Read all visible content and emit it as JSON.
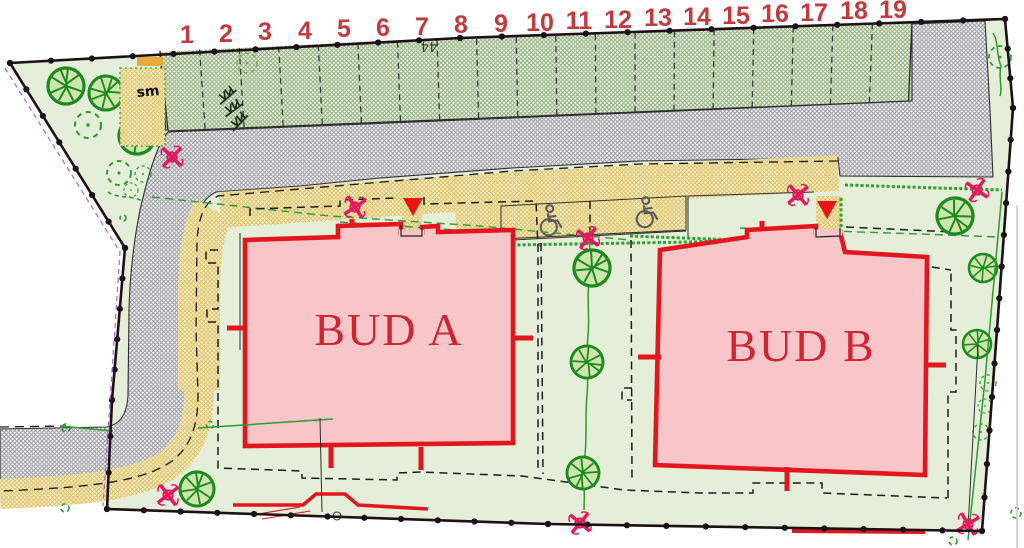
{
  "plan": {
    "title": "Site development plan",
    "buildings": [
      {
        "label": "BUD A"
      },
      {
        "label": "BUD B"
      }
    ],
    "parking": {
      "stalls": [
        "1",
        "2",
        "3",
        "4",
        "5",
        "6",
        "7",
        "8",
        "9",
        "10",
        "11",
        "12",
        "13",
        "14",
        "15",
        "16",
        "17",
        "18",
        "19"
      ],
      "accessible_spaces": 2
    },
    "labels": {
      "sm": "sm",
      "adjacent_parcel": "44"
    },
    "legend_colors": {
      "building_fill": "#f8c5c8",
      "building_border": "#e3161d",
      "building_label": "#ce2533",
      "stall_number": "#c23a3e",
      "survey_marker": "#e6175c",
      "entrance_marker": "#ea1414",
      "tree": "#1e8a1e",
      "hedge": "#2ca32c",
      "lawn": "#e4eed8",
      "road_hatch_line": "#95959d",
      "parking_hatch_line": "#8fac80",
      "sidewalk_hatch_line": "#d9ba5e"
    }
  }
}
